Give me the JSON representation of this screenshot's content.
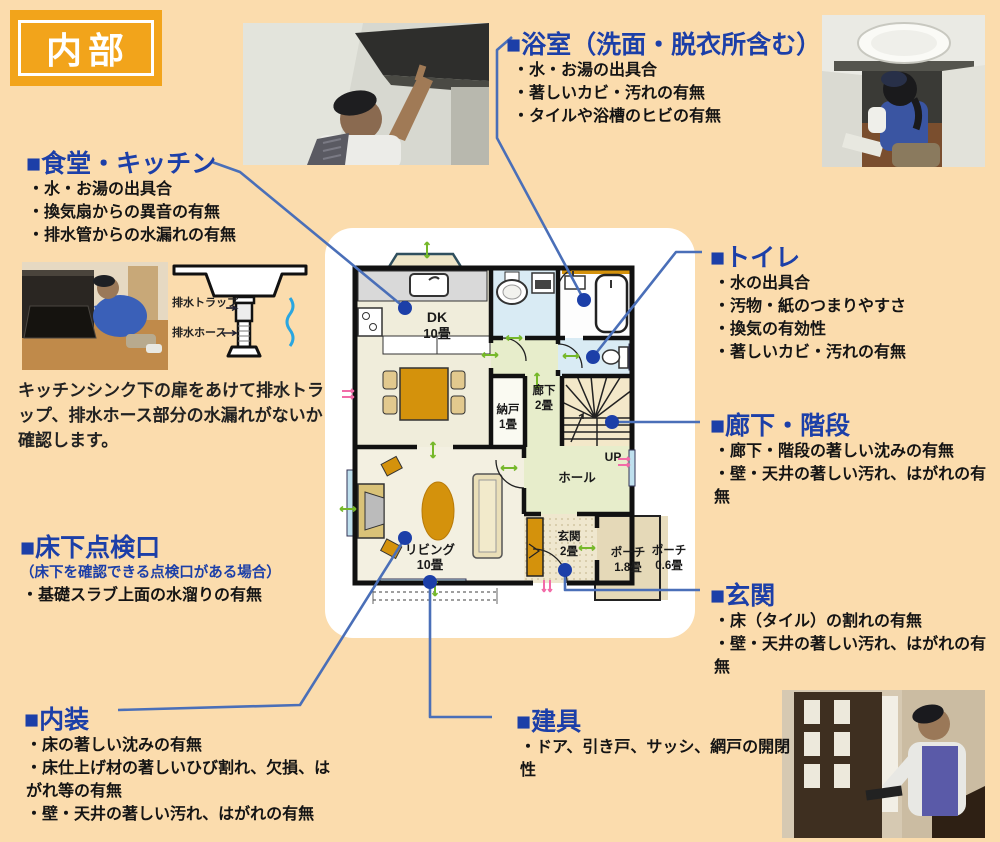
{
  "badge": {
    "label": "内部"
  },
  "colors": {
    "background": "#FBDCAD",
    "badge_orange": "#F2A41B",
    "heading_blue": "#1C3FA8",
    "connector_blue": "#4A6FB8",
    "marker_green": "#76B82A",
    "marker_pink": "#F26CA8",
    "furniture_orange": "#D4920C"
  },
  "sections": {
    "dining_kitchen": {
      "title": "■食堂・キッチン",
      "items": [
        "・水・お湯の出具合",
        "・換気扇からの異音の有無",
        "・排水管からの水漏れの有無"
      ]
    },
    "bathroom": {
      "title": "■浴室（洗面・脱衣所含む）",
      "items": [
        "・水・お湯の出具合",
        "・著しいカビ・汚れの有無",
        "・タイルや浴槽のヒビの有無"
      ]
    },
    "toilet": {
      "title": "■トイレ",
      "items": [
        "・水の出具合",
        "・汚物・紙のつまりやすさ",
        "・換気の有効性",
        "・著しいカビ・汚れの有無"
      ]
    },
    "hallway_stairs": {
      "title": "■廊下・階段",
      "items": [
        "・廊下・階段の著しい沈みの有無",
        "・壁・天井の著しい汚れ、はがれの有無"
      ]
    },
    "entrance": {
      "title": "■玄関",
      "items": [
        "・床（タイル）の割れの有無",
        "・壁・天井の著しい汚れ、はがれの有無"
      ]
    },
    "underfloor": {
      "title": "■床下点検口",
      "note": "（床下を確認できる点検口がある場合）",
      "items": [
        "・基礎スラブ上面の水溜りの有無"
      ]
    },
    "interior": {
      "title": "■内装",
      "items": [
        "・床の著しい沈みの有無",
        "・床仕上げ材の著しいひび割れ、欠損、はがれ等の有無",
        "・壁・天井の著しい汚れ、はがれの有無"
      ]
    },
    "fittings": {
      "title": "■建具",
      "items": [
        "・ドア、引き戸、サッシ、網戸の開閉性"
      ]
    }
  },
  "kitchen_note": "キッチンシンク下の扉をあけて排水トラップ、排水ホース部分の水漏れがないか確認します。",
  "sink_diagram": {
    "trap_label": "排水トラップ",
    "hose_label": "排水ホース"
  },
  "floor_plan": {
    "dk_name": "DK",
    "dk_size": "10畳",
    "closet_name": "納戸",
    "closet_size": "1畳",
    "corridor_name": "廊下",
    "corridor_size": "2畳",
    "hall_label": "ホール",
    "up_label": "UP",
    "living_name": "リビング",
    "living_size": "10畳",
    "entrance_name": "玄関",
    "entrance_size": "2畳",
    "porch1_name": "ポーチ",
    "porch1_size": "1.8畳",
    "porch2_name": "ポーチ",
    "porch2_size": "0.6畳"
  }
}
